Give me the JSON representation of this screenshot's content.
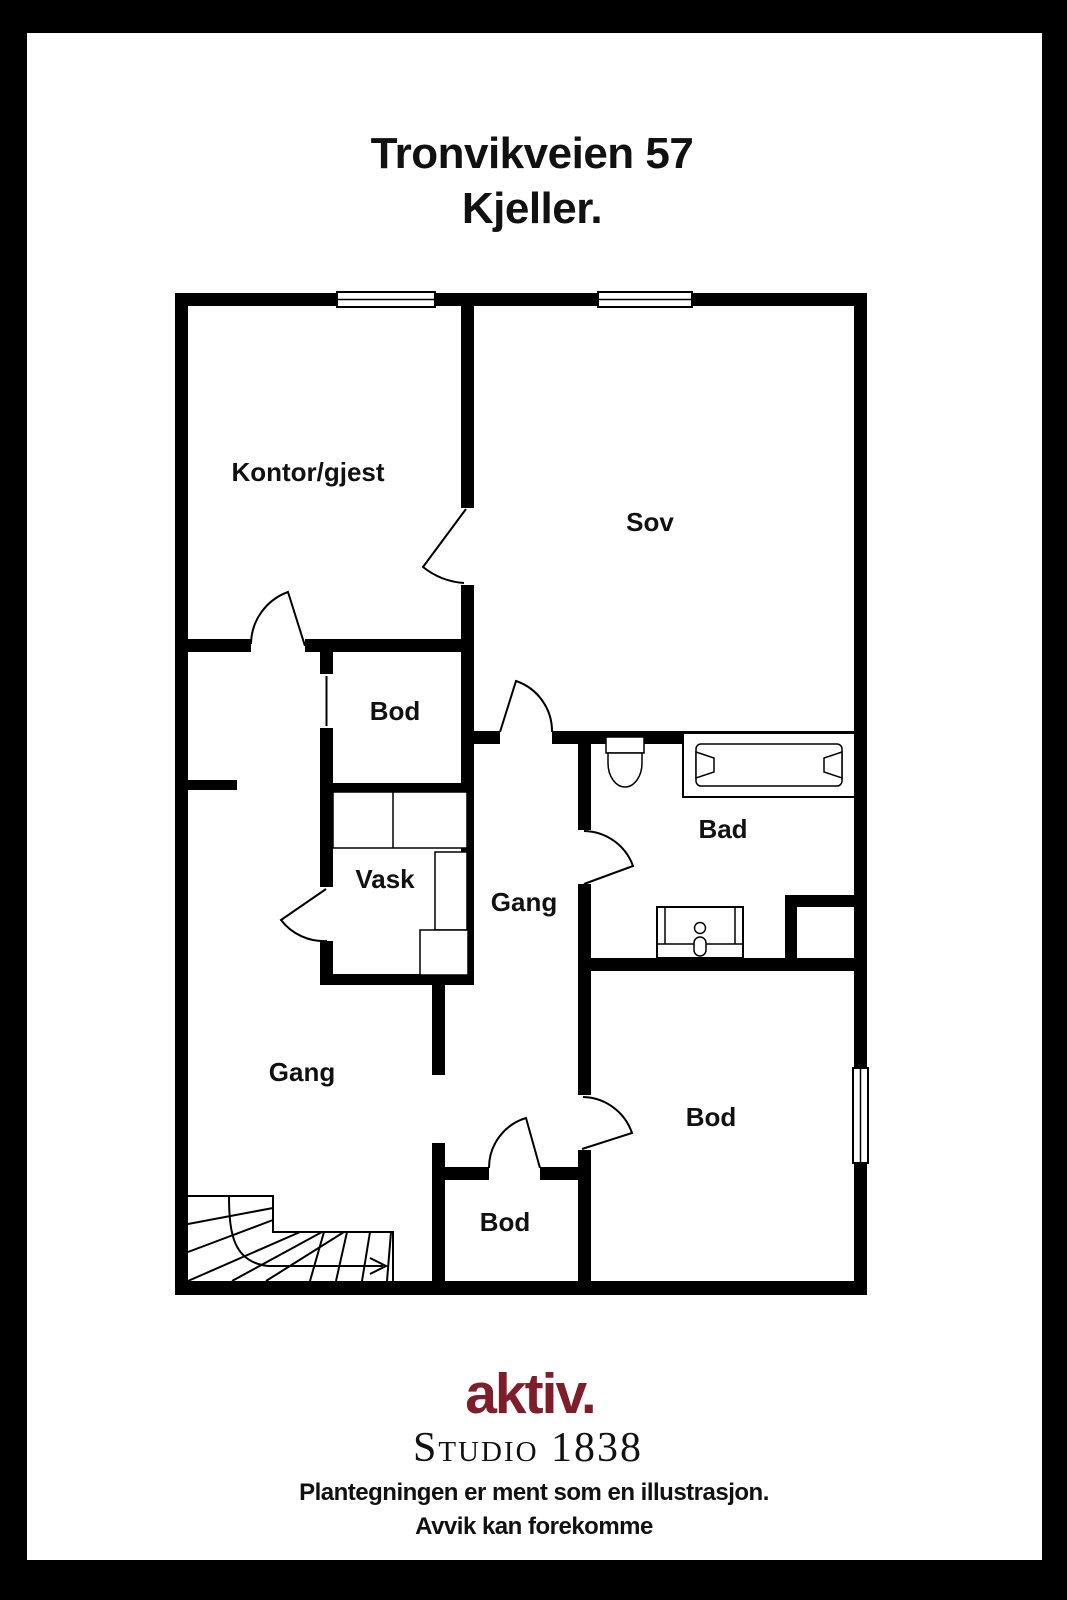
{
  "title": {
    "line1": "Tronvikveien 57",
    "line2": "Kjeller."
  },
  "floorplan": {
    "wall_color": "#000000",
    "rooms": [
      {
        "id": "kontor-gjest",
        "label": "Kontor/gjest"
      },
      {
        "id": "sov",
        "label": "Sov"
      },
      {
        "id": "bod-upper",
        "label": "Bod"
      },
      {
        "id": "vask",
        "label": "Vask"
      },
      {
        "id": "gang-upper",
        "label": "Gang"
      },
      {
        "id": "bad",
        "label": "Bad"
      },
      {
        "id": "gang-lower",
        "label": "Gang"
      },
      {
        "id": "bod-right",
        "label": "Bod"
      },
      {
        "id": "bod-center",
        "label": "Bod"
      }
    ],
    "fixtures": [
      "toilet",
      "bathtub",
      "sink",
      "laundry-cabinets",
      "staircase",
      "stair-direction-arrow",
      "window",
      "door-swing"
    ]
  },
  "footer": {
    "logo_text": "aktiv.",
    "logo_color": "#7e1e2b",
    "studio_text": "Studio 1838",
    "disclaimer_line1": "Plantegningen er ment som en illustrasjon.",
    "disclaimer_line2": "Avvik kan forekomme"
  }
}
